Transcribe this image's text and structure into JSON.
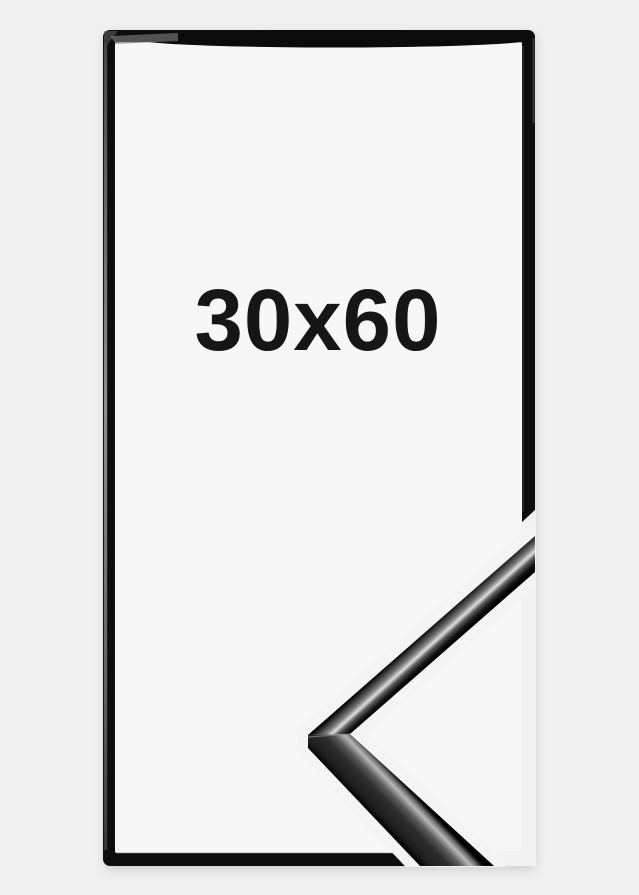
{
  "product": {
    "size_label": "30x60"
  },
  "colors": {
    "page_bg": "#f0f0f1",
    "frame": "#0f0f10",
    "opening_bg": "#f7f7f8",
    "label_text": "#161616",
    "knockout_gap": "#f4f4f5",
    "border_gap": "#f2f2f3"
  }
}
